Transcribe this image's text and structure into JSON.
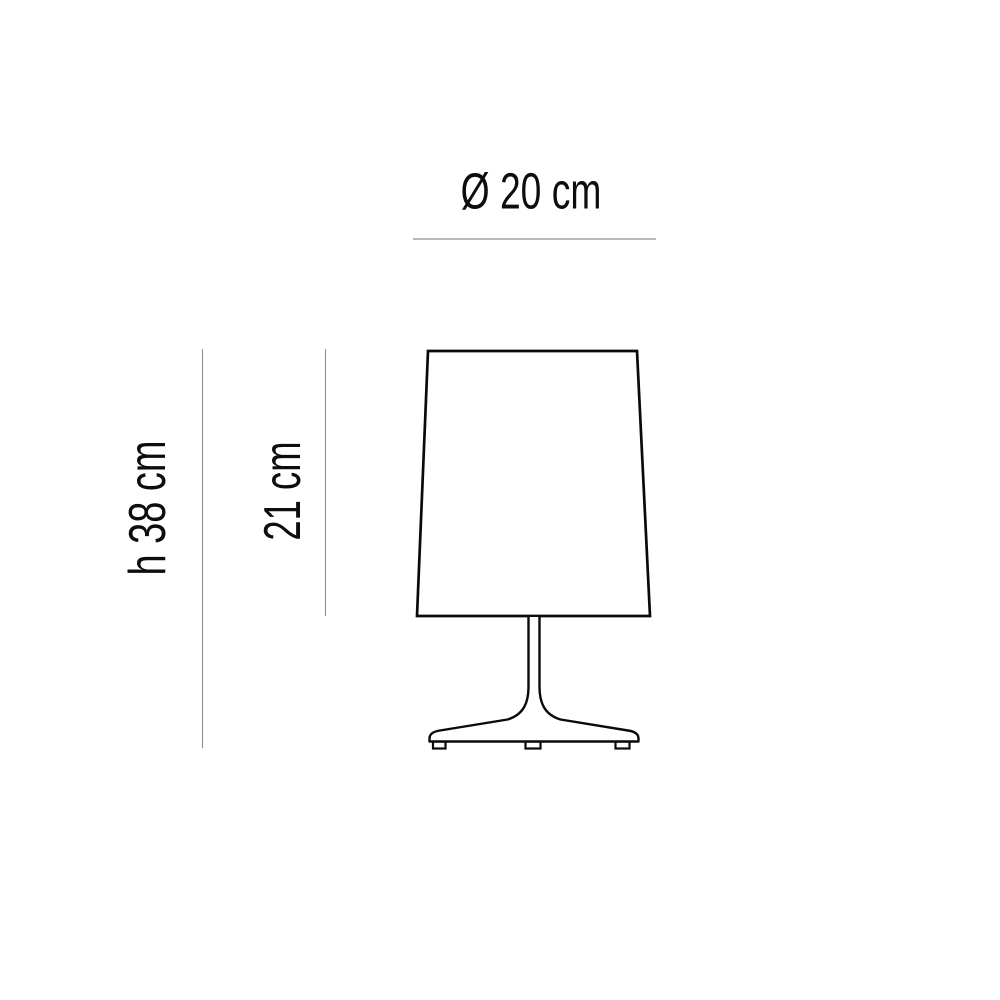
{
  "diagram": {
    "subject": "table lamp dimension drawing",
    "labels": {
      "diameter": "Ø 20 cm",
      "total_height": "h 38 cm",
      "shade_height": "21 cm"
    },
    "measurements": {
      "shade_diameter_cm": 20,
      "total_height_cm": 38,
      "shade_height_cm": 21
    },
    "colors": {
      "background": "#ffffff",
      "ink": "#0a0a0a",
      "text": "#0d0d0d",
      "dimension_line": "#8a8a8a",
      "diameter_underline": "#b9b9b9"
    }
  }
}
